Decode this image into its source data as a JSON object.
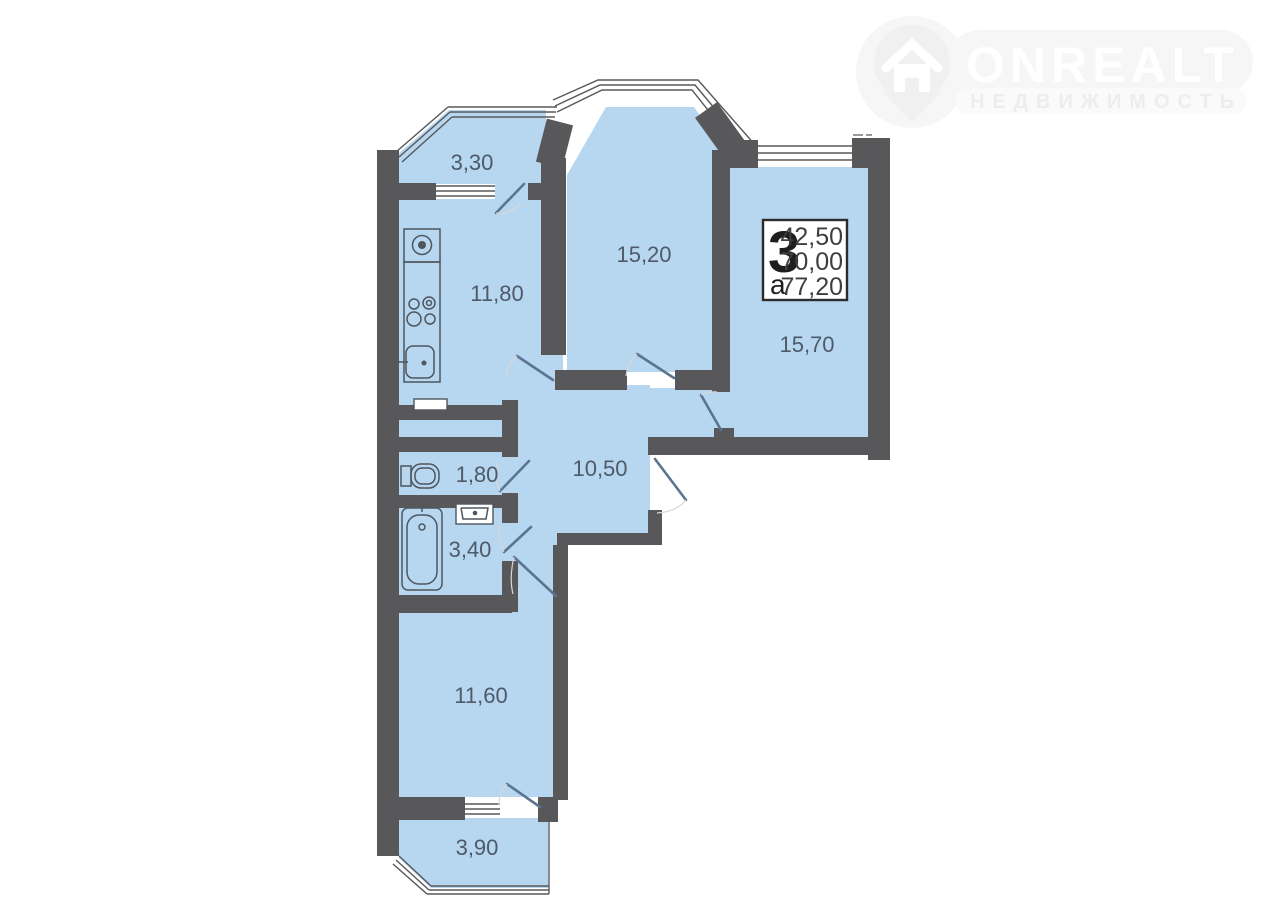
{
  "watermark": {
    "brand": "ONREALT",
    "tagline": "НЕДВИЖИМОСТЬ",
    "icon": "house-pin-icon"
  },
  "info_box": {
    "room_count": "3",
    "letter": "а",
    "values": [
      "42,50",
      "70,00",
      "77,20"
    ]
  },
  "rooms": {
    "balcony_top": "3,30",
    "kitchen": "11,80",
    "living": "15,20",
    "bedroom_right": "15,70",
    "hall": "10,50",
    "wc": "1,80",
    "bath": "3,40",
    "bedroom_bottom": "11,60",
    "balcony_bottom": "3,90"
  },
  "colors": {
    "floor_fill": "#b7d6f0",
    "wall": "#58585a",
    "room_label": "#4e5a68",
    "door_leaf": "#5b7590"
  }
}
